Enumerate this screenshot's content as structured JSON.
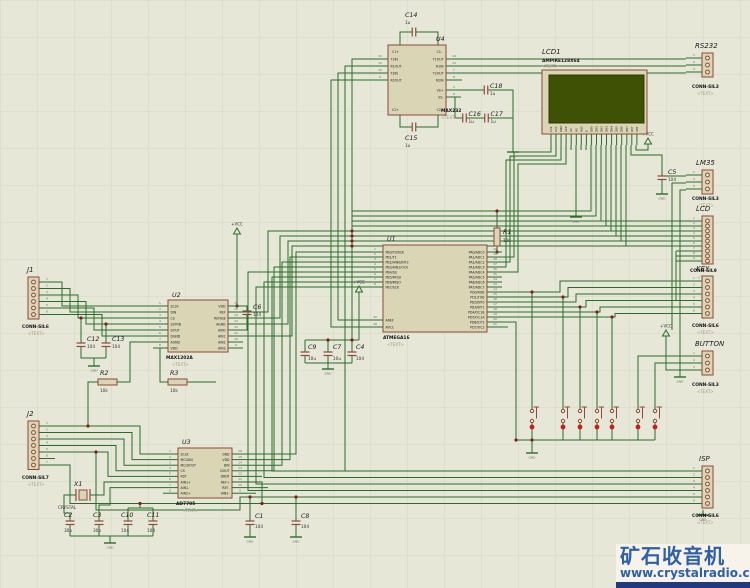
{
  "watermark": {
    "title": "矿石收音机",
    "url": "www.crystalradio.cn"
  },
  "placeholder": "<TEXT>",
  "power": {
    "vcc": "+VCC",
    "gnd": "GND"
  },
  "colors": {
    "background": "#e7e7d7",
    "grid": "#d6d6c6",
    "wire": "#2a6e2a",
    "component_outline": "#8e4a3a",
    "component_fill": "#d9d5b5",
    "lcd_screen": "#3e5104",
    "junction": "#7d1f1f",
    "button_dot": "#c41e1e",
    "watermark_blue": "#2e5fa9",
    "watermark_bar": "#22397c"
  },
  "chips": {
    "U1": {
      "ref": "U1",
      "part": "ATMEGA16",
      "left": [
        [
          "1",
          "PB0/T0/XCK"
        ],
        [
          "2",
          "PB1/T1"
        ],
        [
          "3",
          "PB2/AIN0/INT2"
        ],
        [
          "4",
          "PB3/AIN1/OC0"
        ],
        [
          "5",
          "PB4/SS"
        ],
        [
          "6",
          "PB5/MOSI"
        ],
        [
          "7",
          "PB6/MISO"
        ],
        [
          "8",
          "PB7/SCK"
        ]
      ],
      "bottom_left": [
        [
          "32",
          "AREF"
        ],
        [
          "30",
          "AVCC"
        ]
      ],
      "right": [
        [
          "40",
          "PA0/ADC0"
        ],
        [
          "39",
          "PA1/ADC1"
        ],
        [
          "38",
          "PA2/ADC2"
        ],
        [
          "37",
          "PA3/ADC3"
        ],
        [
          "36",
          "PA4/ADC4"
        ],
        [
          "35",
          "PA5/ADC5"
        ],
        [
          "34",
          "PA6/ADC6"
        ],
        [
          "33",
          "PA7/ADC7"
        ],
        [
          "14",
          "PD0/RXD"
        ],
        [
          "15",
          "PD1/TXD"
        ],
        [
          "16",
          "PD2/INT0"
        ],
        [
          "17",
          "PD3/INT1"
        ],
        [
          "18",
          "PD4/OC1B"
        ],
        [
          "19",
          "PD5/OC1A"
        ],
        [
          "20",
          "PD6/ICP1"
        ],
        [
          "21",
          "PD7/OC2"
        ]
      ]
    },
    "U2": {
      "ref": "U2",
      "part": "MAX1202A",
      "left": [
        [
          "1",
          "SCLK"
        ],
        [
          "2",
          "DIN"
        ],
        [
          "3",
          "CS"
        ],
        [
          "4",
          "SSTRB"
        ],
        [
          "5",
          "DOUT"
        ],
        [
          "6",
          "DGND"
        ],
        [
          "7",
          "AGND"
        ],
        [
          "8",
          "VDD"
        ]
      ],
      "right": [
        [
          "16",
          "VDD"
        ],
        [
          "15",
          "REF"
        ],
        [
          "14",
          "REFADJ"
        ],
        [
          "13",
          "AGND"
        ],
        [
          "12",
          "AIN0"
        ],
        [
          "11",
          "AIN1"
        ],
        [
          "10",
          "AIN2"
        ],
        [
          "9",
          "AIN3"
        ]
      ]
    },
    "U3": {
      "ref": "U3",
      "part": "AD7705",
      "left": [
        [
          "1",
          "SCLK"
        ],
        [
          "2",
          "MCLKIN"
        ],
        [
          "3",
          "MCLKOUT"
        ],
        [
          "4",
          "CS"
        ],
        [
          "5",
          "RST"
        ],
        [
          "6",
          "AIN1+"
        ],
        [
          "7",
          "AIN1-"
        ],
        [
          "8",
          "AIN2+"
        ]
      ],
      "right": [
        [
          "16",
          "GND"
        ],
        [
          "15",
          "VDD"
        ],
        [
          "14",
          "DIN"
        ],
        [
          "13",
          "DOUT"
        ],
        [
          "12",
          "DRDY"
        ],
        [
          "11",
          "REF+"
        ],
        [
          "10",
          "REF-"
        ],
        [
          "9",
          "AIN2-"
        ]
      ]
    },
    "U4": {
      "ref": "U4",
      "part": "MAX232",
      "corners": [
        "C1+",
        "C1-",
        "C2+",
        "C2-"
      ],
      "left": [
        [
          "11",
          "T1IN"
        ],
        [
          "12",
          "R1OUT"
        ],
        [
          "10",
          "T2IN"
        ],
        [
          "9",
          "R2OUT"
        ]
      ],
      "right": [
        [
          "14",
          "T1OUT"
        ],
        [
          "13",
          "R1IN"
        ],
        [
          "7",
          "T2OUT"
        ],
        [
          "8",
          "R2IN"
        ],
        [
          "2",
          "VS+"
        ],
        [
          "6",
          "VS-"
        ]
      ]
    }
  },
  "lcd": {
    "ref": "LCD1",
    "part": "AMPIRE128X64",
    "pins": [
      "CS1",
      "CS2",
      "GND",
      "VCC",
      "V0",
      "RS",
      "R/W",
      "E",
      "DB0",
      "DB1",
      "DB2",
      "DB3",
      "DB4",
      "DB5",
      "DB6",
      "DB7",
      "RST",
      "VEE"
    ]
  },
  "connectors": {
    "RS232": {
      "name": "RS232",
      "part": "CONN-SIL3"
    },
    "LM35": {
      "name": "LM35",
      "part": "CONN-SIL3"
    },
    "LCD": {
      "name": "LCD",
      "part": "CONN-SIL9"
    },
    "KEY": {
      "name": "KEY",
      "part": "CONN-SIL6"
    },
    "BUTTON": {
      "name": "BUTTON",
      "part": "CONN-SIL3"
    },
    "ISP": {
      "name": "ISP",
      "part": "CONN-SIL6"
    },
    "J1": {
      "name": "J1",
      "part": "CONN-SIL6"
    },
    "J2": {
      "name": "J2",
      "part": "CONN-SIL7"
    }
  },
  "passives": {
    "C1": {
      "ref": "C1",
      "value": "104"
    },
    "C2": {
      "ref": "C2",
      "value": "30p"
    },
    "C3": {
      "ref": "C3",
      "value": "30p"
    },
    "C4": {
      "ref": "C4",
      "value": "104"
    },
    "C5": {
      "ref": "C5",
      "value": "104"
    },
    "C6": {
      "ref": "C6",
      "value": "104"
    },
    "C7": {
      "ref": "C7",
      "value": "10u"
    },
    "C8": {
      "ref": "C8",
      "value": "104"
    },
    "C9": {
      "ref": "C9",
      "value": "10u"
    },
    "C10": {
      "ref": "C10",
      "value": "104"
    },
    "C11": {
      "ref": "C11",
      "value": "104"
    },
    "C12": {
      "ref": "C12",
      "value": "104"
    },
    "C13": {
      "ref": "C13",
      "value": "104"
    },
    "C14": {
      "ref": "C14",
      "value": "1u"
    },
    "C15": {
      "ref": "C15",
      "value": "1u"
    },
    "C16": {
      "ref": "C16",
      "value": "1u"
    },
    "C17": {
      "ref": "C17",
      "value": "1u"
    },
    "C18": {
      "ref": "C18",
      "value": "1u"
    },
    "R1": {
      "ref": "R1",
      "value": "10k"
    },
    "R2": {
      "ref": "R2",
      "value": "10k"
    },
    "R3": {
      "ref": "R3",
      "value": "10k"
    },
    "X1": {
      "ref": "X1",
      "value": "CRYSTAL"
    }
  }
}
